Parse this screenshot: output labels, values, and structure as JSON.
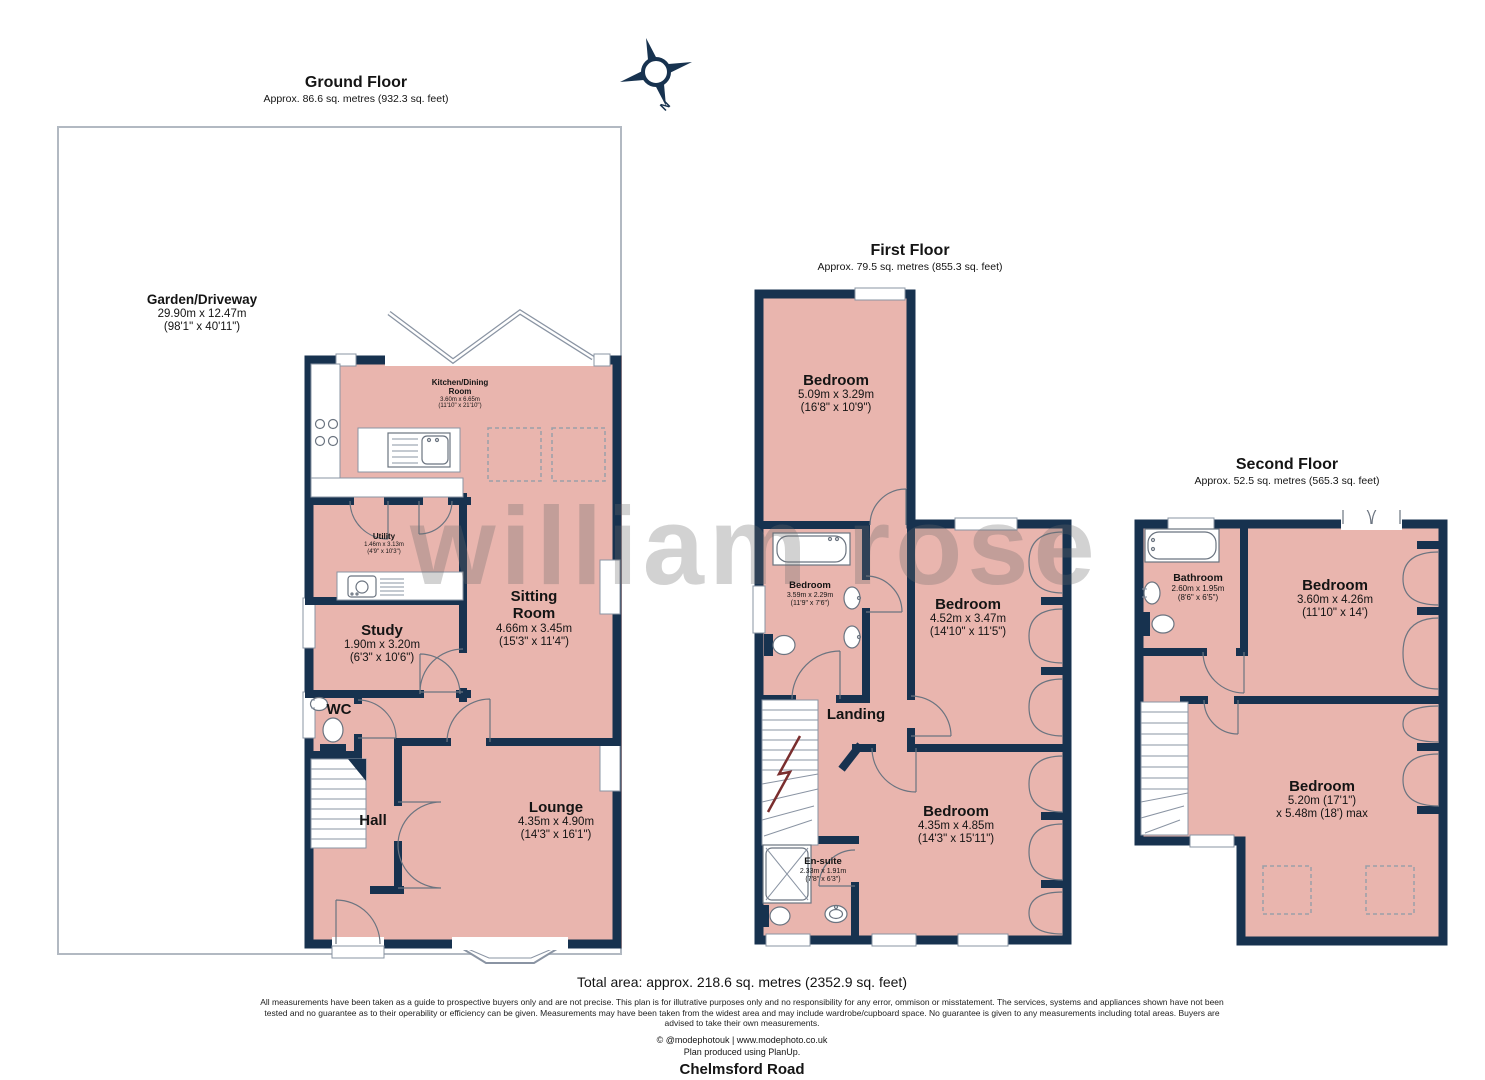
{
  "watermark": "william rose",
  "compass": {
    "label": "N"
  },
  "colors": {
    "wall": "#17324f",
    "room_fill": "#e9b5ae"
  },
  "floors": {
    "ground": {
      "title": "Ground Floor",
      "area": "Approx. 86.6 sq. metres (932.3 sq. feet)",
      "rooms": {
        "garden": {
          "name": "Garden/Driveway",
          "metric": "29.90m x 12.47m",
          "imperial": "(98'1\" x 40'11\")"
        },
        "kitchen": {
          "name_line1": "Kitchen/Dining",
          "name_line2": "Room",
          "metric": "3.60m x 6.65m",
          "imperial": "(11'10\" x 21'10\")"
        },
        "utility": {
          "name": "Utility",
          "metric": "1.46m x 3.13m",
          "imperial": "(4'9\" x 10'3\")"
        },
        "study": {
          "name": "Study",
          "metric": "1.90m x 3.20m",
          "imperial": "(6'3\" x 10'6\")"
        },
        "sitting": {
          "name_line1": "Sitting",
          "name_line2": "Room",
          "metric": "4.66m x 3.45m",
          "imperial": "(15'3\" x 11'4\")"
        },
        "wc": {
          "name": "WC"
        },
        "hall": {
          "name": "Hall"
        },
        "lounge": {
          "name": "Lounge",
          "metric": "4.35m x 4.90m",
          "imperial": "(14'3\" x 16'1\")"
        }
      }
    },
    "first": {
      "title": "First Floor",
      "area": "Approx. 79.5 sq. metres (855.3 sq. feet)",
      "rooms": {
        "bedroom1": {
          "name": "Bedroom",
          "metric": "5.09m x 3.29m",
          "imperial": "(16'8\" x 10'9\")"
        },
        "bedroom2": {
          "name": "Bedroom",
          "metric": "3.59m x 2.29m",
          "imperial": "(11'9\" x 7'6\")"
        },
        "bedroom3": {
          "name": "Bedroom",
          "metric": "4.52m x 3.47m",
          "imperial": "(14'10\" x 11'5\")"
        },
        "landing": {
          "name": "Landing"
        },
        "bedroom4": {
          "name": "Bedroom",
          "metric": "4.35m x 4.85m",
          "imperial": "(14'3\" x 15'11\")"
        },
        "ensuite": {
          "name": "En-suite",
          "metric": "2.33m x 1.91m",
          "imperial": "(7'8\" x 6'3\")"
        }
      }
    },
    "second": {
      "title": "Second Floor",
      "area": "Approx. 52.5 sq. metres (565.3 sq. feet)",
      "rooms": {
        "bathroom": {
          "name": "Bathroom",
          "metric": "2.60m x 1.95m",
          "imperial": "(8'6\" x 6'5\")"
        },
        "bedroom5": {
          "name": "Bedroom",
          "metric": "3.60m x 4.26m",
          "imperial": "(11'10\" x 14')"
        },
        "bedroom6": {
          "name": "Bedroom",
          "metric": "5.20m (17'1\")",
          "imperial": "x 5.48m (18') max"
        }
      }
    }
  },
  "footer": {
    "total_area": "Total area: approx. 218.6 sq. metres (2352.9 sq. feet)",
    "disclaimer": "All measurements have been taken as a guide to prospective buyers only and are not precise. This plan is for illutrative purposes only and no responsibility for any error, ommison or misstatement. The services, systems and appliances shown have not been tested and no guarantee as to their operability or efficiency can be given. Measurements may have been taken from the widest area and may include wardrobe/cupboard space. No guarantee is given to any measurements including total areas. Buyers are advised to take their own measurements.",
    "credit": "© @modephotouk | www.modephoto.co.uk",
    "produced": "Plan produced using PlanUp.",
    "address": "Chelmsford Road"
  }
}
